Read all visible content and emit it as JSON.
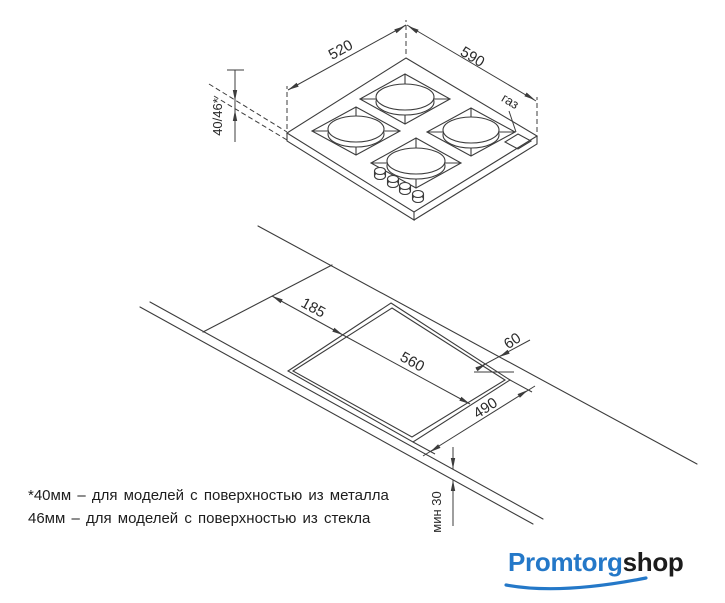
{
  "hob_drawing": {
    "width_label": "520",
    "depth_label": "590",
    "thickness_label": "40/46*",
    "gas_label": "газ"
  },
  "cutout_drawing": {
    "offset_left_label": "185",
    "cutout_length_label": "560",
    "back_clearance_label": "60",
    "cutout_width_label": "490",
    "front_clearance_label": "мин 30"
  },
  "footnote": {
    "line1": "*40мм – для моделей с поверхностью из металла",
    "line2": "46мм – для моделей с поверхностью из стекла"
  },
  "logo": {
    "part1": "Promtorg",
    "part2": "shop",
    "accent_color": "#2478c8",
    "text_color": "#1c1c1c"
  },
  "colors": {
    "line": "#3c3c3c",
    "text": "#2a2a2a",
    "background": "#ffffff"
  }
}
